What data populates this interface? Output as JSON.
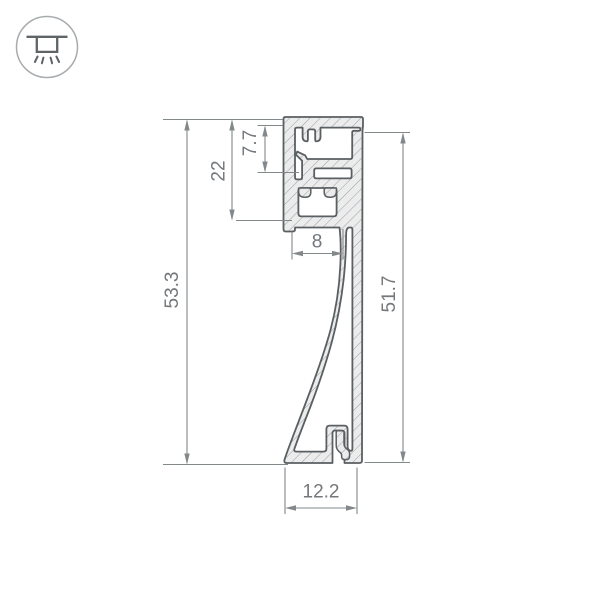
{
  "icon": {
    "name": "recessed-profile-light-icon"
  },
  "drawing": {
    "dimensions": {
      "total_height": "53.3",
      "top_box_depth": "22",
      "cover_recess_depth": "7.7",
      "led_channel_width": "8",
      "back_wall_height": "51.7",
      "base_width": "12.2"
    },
    "colors": {
      "outline": "#5a5f62",
      "section_fill": "#ececec",
      "hatch": "#9aa0a3",
      "dimension_lines": "#83888b",
      "dimension_text": "#74787b",
      "icon_stroke": "#a7abad"
    }
  }
}
